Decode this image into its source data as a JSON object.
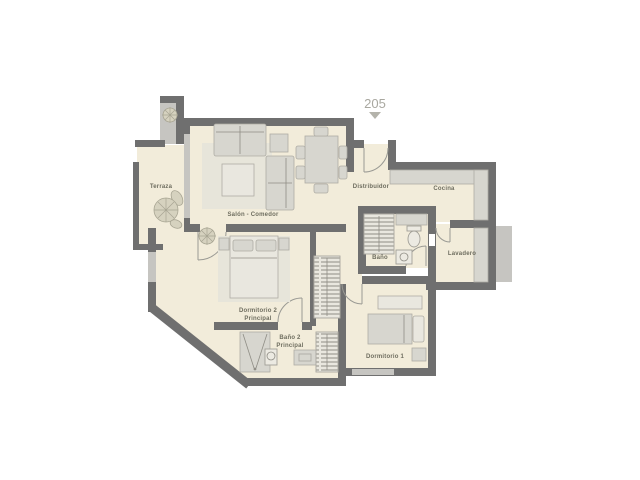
{
  "title": {
    "unit_number": "205"
  },
  "rooms": {
    "terraza": {
      "label": "Terraza"
    },
    "salon": {
      "label": "Salón - Comedor"
    },
    "distribuidor": {
      "label": "Distribuidor"
    },
    "cocina": {
      "label": "Cocina"
    },
    "bano": {
      "label": "Baño"
    },
    "lavadero": {
      "label": "Lavadero"
    },
    "dormitorio2": {
      "label_line1": "Dormitorio 2",
      "label_line2": "Principal"
    },
    "bano2": {
      "label_line1": "Baño 2",
      "label_line2": "Principal"
    },
    "dormitorio1": {
      "label": "Dormitorio 1"
    }
  },
  "colors": {
    "background": "#ffffff",
    "wall": "#6f6f6f",
    "wall_light": "#c6c5c1",
    "floor": "#f2ecda",
    "rug": "#e7e5da",
    "furniture": "#d7d6cf",
    "furniture_border": "#aeaca4",
    "accent_text": "#6e6d5f",
    "unit_text": "#a9a8a0",
    "door_arc": "#9a9a94"
  }
}
